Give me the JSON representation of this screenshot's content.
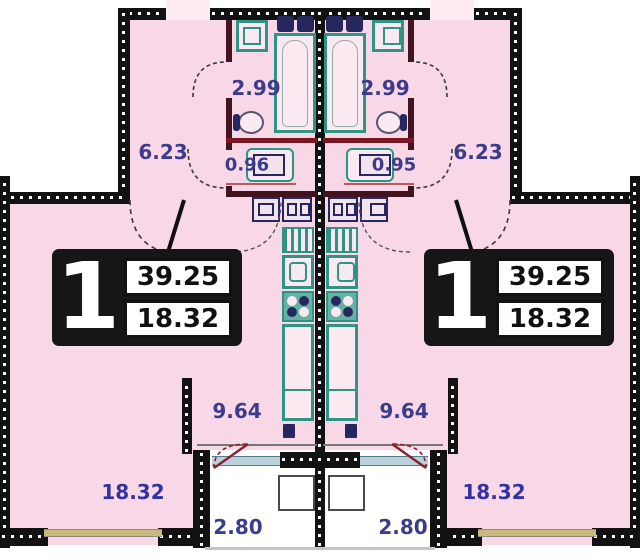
{
  "plan_title": "two mirrored 1-room apartment floor plans",
  "left_apartment": {
    "card": {
      "number": "1",
      "total_area": "39.25",
      "living_area": "18.32"
    },
    "rooms": {
      "bathroom": "2.99",
      "hallway": "6.23",
      "wc": "0.96",
      "kitchen": "9.64",
      "living_room": "18.32",
      "balcony": "2.80"
    }
  },
  "right_apartment": {
    "card": {
      "number": "1",
      "total_area": "39.25",
      "living_area": "18.32"
    },
    "rooms": {
      "bathroom": "2.99",
      "hallway": "6.23",
      "wc": "0.95",
      "kitchen": "9.64",
      "living_room": "18.32",
      "balcony": "2.80"
    }
  },
  "colors": {
    "floor_pink": "#f8d7e6",
    "wall_black": "#121212",
    "fixture_teal": "#2f9484",
    "fixture_navy": "#27275f",
    "label_navy": "#3c3c8a",
    "living_label_blue": "#3232a2",
    "door_maroon": "#8b2030",
    "window_tan": "#c9b97b",
    "window_blue": "#b9d2da"
  }
}
